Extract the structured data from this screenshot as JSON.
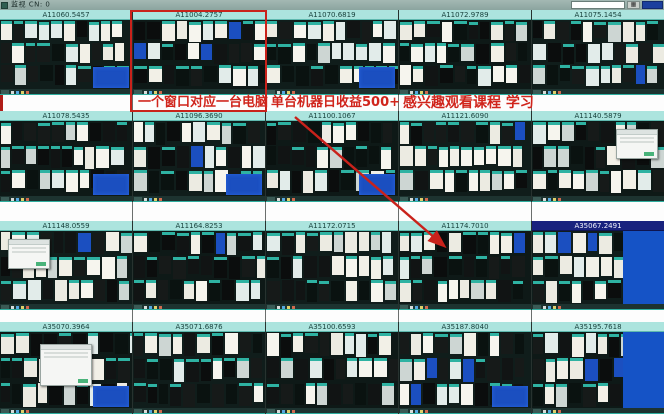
{
  "window": {
    "title": "监视 CN: 0",
    "controls": {
      "search_value": "",
      "grid_icon": "▦",
      "action_label": ""
    }
  },
  "annotations": {
    "texts": [
      "一个窗口对应一台电脑",
      "单台机器日收益500+",
      "感兴趣观看课程 学习"
    ],
    "accent": "#c9221b"
  },
  "grid": {
    "rows": 4,
    "cols": 5,
    "panels": [
      {
        "label": "A11060.5457",
        "selected": false,
        "features": {
          "blue_tile": true
        }
      },
      {
        "label": "A11004.2757",
        "selected": false,
        "features": {
          "highlighted": true
        }
      },
      {
        "label": "A11070.6819",
        "selected": false,
        "features": {
          "blue_tile": true
        }
      },
      {
        "label": "A11072.9789",
        "selected": false,
        "features": {}
      },
      {
        "label": "A11075.1454",
        "selected": false,
        "features": {}
      },
      {
        "label": "A11078.5435",
        "selected": false,
        "features": {
          "blue_tile": true
        }
      },
      {
        "label": "A11096.3690",
        "selected": false,
        "features": {
          "blue_tile": true
        }
      },
      {
        "label": "A11100.1067",
        "selected": false,
        "features": {
          "blue_tile": true
        }
      },
      {
        "label": "A11121.6090",
        "selected": false,
        "features": {}
      },
      {
        "label": "A11140.5879",
        "selected": false,
        "features": {
          "dialog": "right"
        }
      },
      {
        "label": "A11148.0559",
        "selected": false,
        "features": {
          "dialog": "left"
        }
      },
      {
        "label": "A11164.8253",
        "selected": false,
        "features": {}
      },
      {
        "label": "A11172.0715",
        "selected": false,
        "features": {}
      },
      {
        "label": "A11174.7010",
        "selected": false,
        "features": {}
      },
      {
        "label": "A35067.2491",
        "selected": true,
        "features": {
          "blue_desktop": true
        }
      },
      {
        "label": "A35070.3964",
        "selected": false,
        "features": {
          "dialog": "center",
          "blue_tile": true
        }
      },
      {
        "label": "A35071.6876",
        "selected": false,
        "features": {}
      },
      {
        "label": "A35100.6593",
        "selected": false,
        "features": {}
      },
      {
        "label": "A35187.8040",
        "selected": false,
        "features": {
          "blue_tile": true
        }
      },
      {
        "label": "A35195.7618",
        "selected": false,
        "features": {
          "blue_desktop": true
        }
      }
    ]
  },
  "colors": {
    "titlebar_bg": "#93aba6",
    "header_bg": "#ace4de",
    "header_selected_bg": "#18227e",
    "panel_bg": "#101d1b",
    "thumb_teal": "#2eb2a2",
    "blue": "#1b4fc0",
    "annotation_red": "#c9221b"
  }
}
